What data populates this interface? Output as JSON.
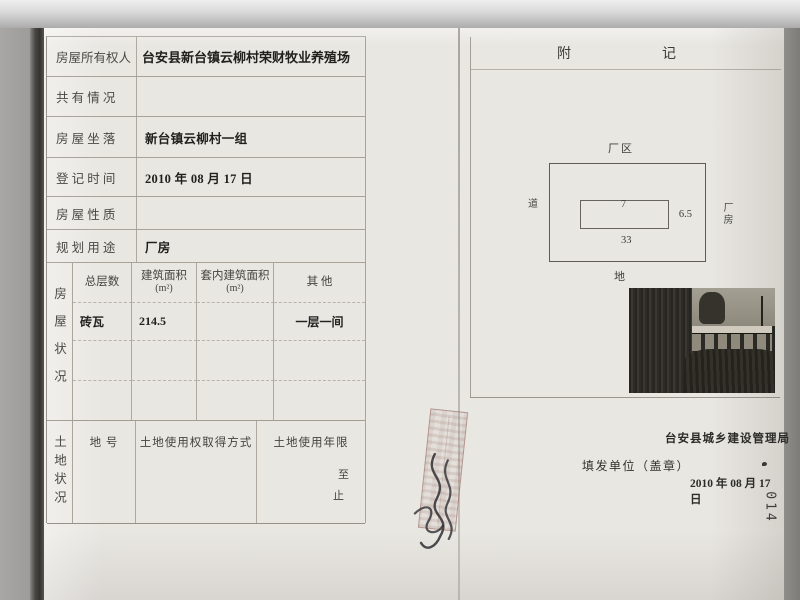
{
  "form": {
    "rows": [
      {
        "label": "房屋所有权人",
        "value": "台安县新台镇云柳村荣财牧业养殖场"
      },
      {
        "label": "共 有 情 况",
        "value": ""
      },
      {
        "label": "房 屋 坐 落",
        "value": "新台镇云柳村一组"
      },
      {
        "label": "登 记 时 间",
        "value": "2010 年 08 月 17 日"
      },
      {
        "label": "房 屋 性 质",
        "value": ""
      },
      {
        "label": "规 划 用 途",
        "value": "厂房"
      }
    ],
    "building": {
      "side_label": "房屋状况",
      "col_headers": [
        "总层数",
        "建筑面积",
        "套内建筑面积",
        "其  他"
      ],
      "col_units": [
        "",
        "(m²)",
        "(m²)",
        ""
      ],
      "data_row": {
        "structure": "砖瓦",
        "area": "214.5",
        "inner_area": "",
        "other": "一层一间"
      }
    },
    "land": {
      "side_label": "土地状况",
      "plot_header": "地 号",
      "method_header": "土地使用权取得方式",
      "term_header": "土地使用年限",
      "term_to": "至",
      "term_stop": "止"
    }
  },
  "note": {
    "title": "附　　　　　　记",
    "diagram": {
      "area_label": "厂区",
      "left_label": "道",
      "right_label": "厂房",
      "bottom_label": "地",
      "width_top": "7",
      "height_right": "6.5",
      "width_bottom": "33"
    }
  },
  "footer": {
    "authority": "台安县城乡建设管理局",
    "issuer_label": "填发单位（盖章）",
    "date": "2010 年 08 月 17 日"
  },
  "page_number": "014"
}
